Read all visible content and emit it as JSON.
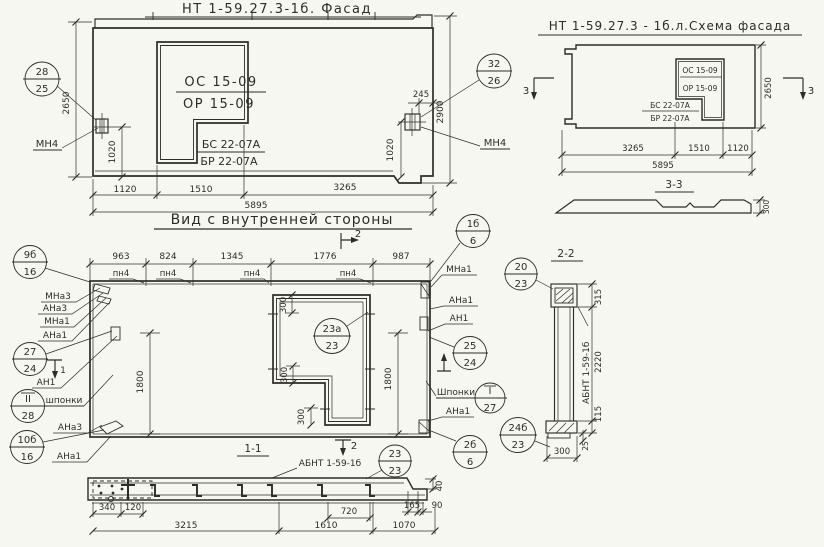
{
  "facade": {
    "title": "НТ 1-59.27.3-1б. Фасад",
    "window_top_label_1": "ОС 15-09",
    "window_top_label_2": "ОР 15-09",
    "window_bottom_label_1": "БС 22-07А",
    "window_bottom_label_2": "БР 22-07А",
    "callout_left": {
      "top": "28",
      "bottom": "25"
    },
    "callout_right": {
      "top": "32",
      "bottom": "26"
    },
    "anchor_left_label": "МН4",
    "anchor_right_label": "МН4",
    "dim_height_left": "2650",
    "dim_height_right": "2900",
    "dim_anchor_left": "1020",
    "dim_anchor_right": "1020",
    "dim_edge_right": "245",
    "dims_bottom": [
      "1120",
      "1510",
      "3265"
    ],
    "dim_total": "5895"
  },
  "scheme": {
    "title": "НТ 1-59.27.3 - 1б.л.Схема фасада",
    "window_top_label_1": "ОС 15-09",
    "window_top_label_2": "ОР 15-09",
    "window_bottom_label_1": "БС 22-07А",
    "window_bottom_label_2": "БР 22-07А",
    "dim_height": "2650",
    "dims_bottom": [
      "3265",
      "1510",
      "1120"
    ],
    "dim_total": "5895",
    "marker_left": "3",
    "marker_right": "3"
  },
  "section33": {
    "title": "3-3",
    "dim_thickness": "300"
  },
  "interior": {
    "title": "Вид с внутренней стороны",
    "dims_top": [
      "963",
      "824",
      "1345",
      "1776",
      "987"
    ],
    "joint_labels": [
      "пн4",
      "пн4",
      "пн4",
      "пн4"
    ],
    "marker_top": "2",
    "marker_bottom": "2",
    "marker_left_label": "1",
    "labels_left": {
      "mna3": "МНа3",
      "ana3": "АНа3",
      "mna1": "МНа1",
      "ana1": "АНа1",
      "an1": "АН1",
      "shponki": "шпонки",
      "ana3_b": "АНа3",
      "ana1_b": "АНа1"
    },
    "labels_right": {
      "mna1": "МНа1",
      "ana1": "АНа1",
      "an1": "АН1",
      "shponki": "Шпонки",
      "ana1_b": "АНа1"
    },
    "callouts": {
      "c1": {
        "top": "9б",
        "bottom": "16"
      },
      "c2": {
        "top": "27",
        "bottom": "24"
      },
      "c3": {
        "top": "II",
        "bottom": "28"
      },
      "c4": {
        "top": "10б",
        "bottom": "16"
      },
      "c5": {
        "top": "1б",
        "bottom": "6"
      },
      "c6": {
        "top": "25",
        "bottom": "24"
      },
      "c7": {
        "top": "I",
        "bottom": "27"
      },
      "c8": {
        "top": "2б",
        "bottom": "6"
      },
      "c9": {
        "top": "24б",
        "bottom": "23"
      },
      "c10": {
        "top": "23а",
        "bottom": "23"
      }
    },
    "dim_height_left": "1800",
    "dim_height_right": "1800",
    "dims_window": [
      "300",
      "300",
      "300"
    ]
  },
  "section22": {
    "title": "2-2",
    "callout": {
      "top": "20",
      "bottom": "23"
    },
    "panel_mark": "АБНТ 1-59-1б",
    "dim_top": "315",
    "dim_body": "2220",
    "dim_shoe": "115",
    "dim_step": "25",
    "dim_width": "300"
  },
  "section11": {
    "title": "1-1",
    "panel_mark": "АБНТ 1-59-1б",
    "callout": {
      "top": "23",
      "bottom": "23"
    },
    "dims_top": [
      "340",
      "120",
      "720",
      "165",
      "90"
    ],
    "dim_step": "40",
    "dims_bottom": [
      "3215",
      "1610",
      "1070"
    ]
  }
}
